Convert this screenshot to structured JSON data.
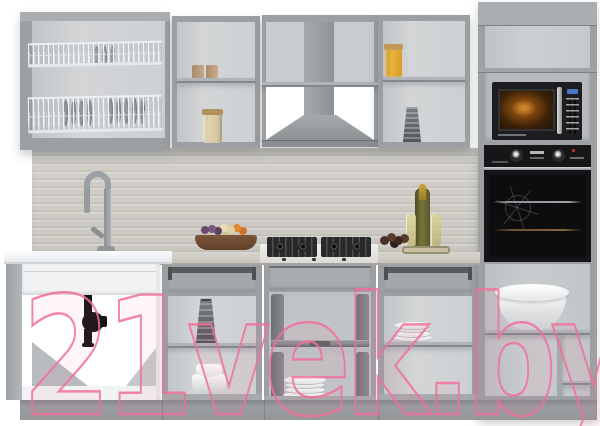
{
  "meta": {
    "type": "product-photo",
    "subject": "modular kitchen furniture set, gray carcasses with open fronts, white background",
    "background_color": "#ffffff"
  },
  "watermark": {
    "text": "21vek.by",
    "color": "#f0709c"
  },
  "palette": {
    "cabinet_gray": "#9ca0a3",
    "interior_gray": "#cdd0d2",
    "white_front": "#f0f2f3",
    "countertop_wood": "#c9c6bf",
    "backsplash_wood": "#cfccc6",
    "appliance_black": "#1a1a1c",
    "microwave_glow": "#c07a26",
    "plinth_gray": "#96999c",
    "accent_yellow_jar": "#e2aa30"
  },
  "scene": {
    "wall_row": [
      {
        "name": "dish-rack-cabinet",
        "items": [
          "wire-drying-rack-upper",
          "wire-drying-rack-lower",
          "plates-in-rack"
        ]
      },
      {
        "name": "open-shelf-unit-left",
        "items": [
          "two-beige-cups",
          "glass-jar-with-grains"
        ]
      },
      {
        "name": "hood-unit",
        "items": [
          "chimney-duct",
          "hood-canopy"
        ]
      },
      {
        "name": "open-shelf-unit-right",
        "items": [
          "yellow-jar",
          "metal-grater"
        ]
      },
      {
        "name": "tall-column-top",
        "items": [
          "empty-niche",
          "built-in-microwave"
        ]
      }
    ],
    "midline": [
      {
        "name": "backsplash",
        "material": "light-gray wood"
      },
      {
        "name": "faucet",
        "color": "gray"
      },
      {
        "name": "sink-countertop",
        "color": "white"
      },
      {
        "name": "main-countertop",
        "material": "light wood"
      },
      {
        "name": "gas-hob",
        "burners": 4
      },
      {
        "name": "fruit-bowl",
        "contents": [
          "grapes",
          "pale-fruit",
          "orange-fruit"
        ]
      },
      {
        "name": "serving-tray",
        "contents": [
          "champagne-bottle",
          "two-glasses",
          "dark-fruits"
        ]
      }
    ],
    "base_row": [
      {
        "name": "sink-base-cabinet",
        "items": [
          "black-drain-siphon"
        ]
      },
      {
        "name": "base-cabinet-a",
        "items": [
          "open-drawer-box",
          "box-grater",
          "white-bowls"
        ]
      },
      {
        "name": "base-cabinet-b-under-hob",
        "items": [
          "pull-out-basket-upper",
          "pull-out-basket-lower",
          "plate-stack"
        ]
      },
      {
        "name": "base-cabinet-c",
        "items": [
          "open-drawer-box",
          "plate-stack"
        ]
      },
      {
        "name": "tall-column-base",
        "items": [
          "built-in-oven",
          "large-white-bowl"
        ]
      }
    ]
  }
}
